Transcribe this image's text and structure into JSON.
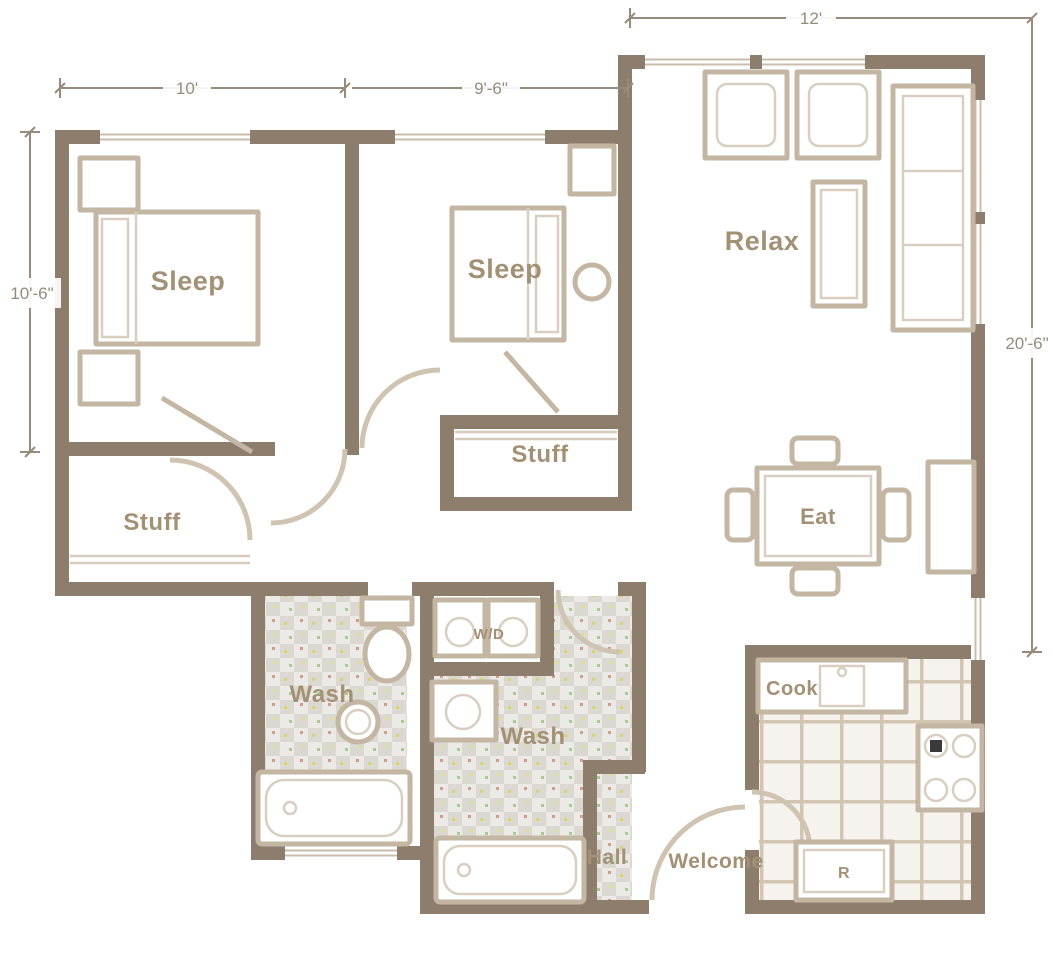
{
  "plan": {
    "type": "apartment-floor-plan",
    "colors": {
      "wall": "#8d7d6c",
      "furniture_outline": "#c3b6a2",
      "room_label": "#a39176",
      "dimension": "#968b7d",
      "bath_tile": "#dbd8d2",
      "kitchen_grid": "#d2c5b2",
      "background": "#ffffff"
    },
    "dims": {
      "bedroom1_width": "10'",
      "bedroom2_width": "9'-6\"",
      "living_width": "12'",
      "bedroom1_depth": "10'-6\"",
      "living_depth": "20'-6\""
    },
    "rooms": {
      "bedroom1": "Sleep",
      "bedroom2": "Sleep",
      "living": "Relax",
      "dining": "Eat",
      "closet1": "Stuff",
      "closet2": "Stuff",
      "bath1": "Wash",
      "bath2": "Wash",
      "laundry": "W/D",
      "kitchen": "Cook",
      "hall": "Hall",
      "entry": "Welcome",
      "refrigerator": "R"
    }
  }
}
